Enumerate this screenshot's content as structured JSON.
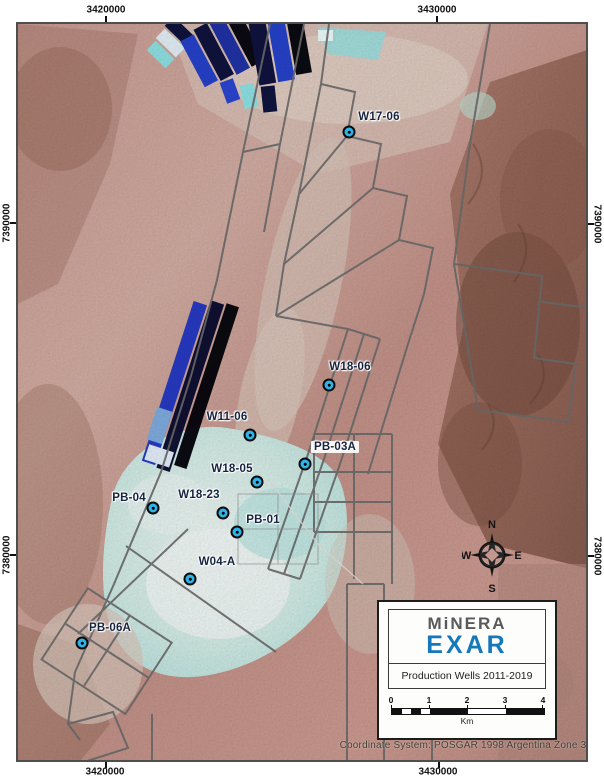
{
  "map": {
    "axis": {
      "top": [
        "3420000",
        "3430000"
      ],
      "bottom": [
        "3420000",
        "3430000"
      ],
      "left": [
        "7390000",
        "7380000"
      ],
      "right": [
        "7390000",
        "7380000"
      ]
    },
    "wells": [
      {
        "label": "W17-06"
      },
      {
        "label": "W18-06"
      },
      {
        "label": "W11-06"
      },
      {
        "label": "PB-03A"
      },
      {
        "label": "W18-05"
      },
      {
        "label": "PB-04"
      },
      {
        "label": "W18-23"
      },
      {
        "label": "PB-01"
      },
      {
        "label": "W04-A"
      },
      {
        "label": "PB-06A"
      }
    ],
    "compass": {
      "n": "N",
      "e": "E",
      "s": "S",
      "w": "W"
    },
    "legend": {
      "brand_line1": "MiNERA",
      "brand_line2": "EXAR",
      "title": "Production Wells  2011-2019",
      "scale_ticks": [
        "0",
        "1",
        "2",
        "3",
        "4"
      ],
      "scale_unit": "Km"
    },
    "coordinate_note": "Coordinate System: POSGAR 1998 Argentina Zone 3",
    "colors": {
      "well_marker": "#2fb4e9",
      "brand_gray": "#58595b",
      "brand_blue": "#1478bb",
      "boundary_gray": "#6f6f6f"
    }
  }
}
